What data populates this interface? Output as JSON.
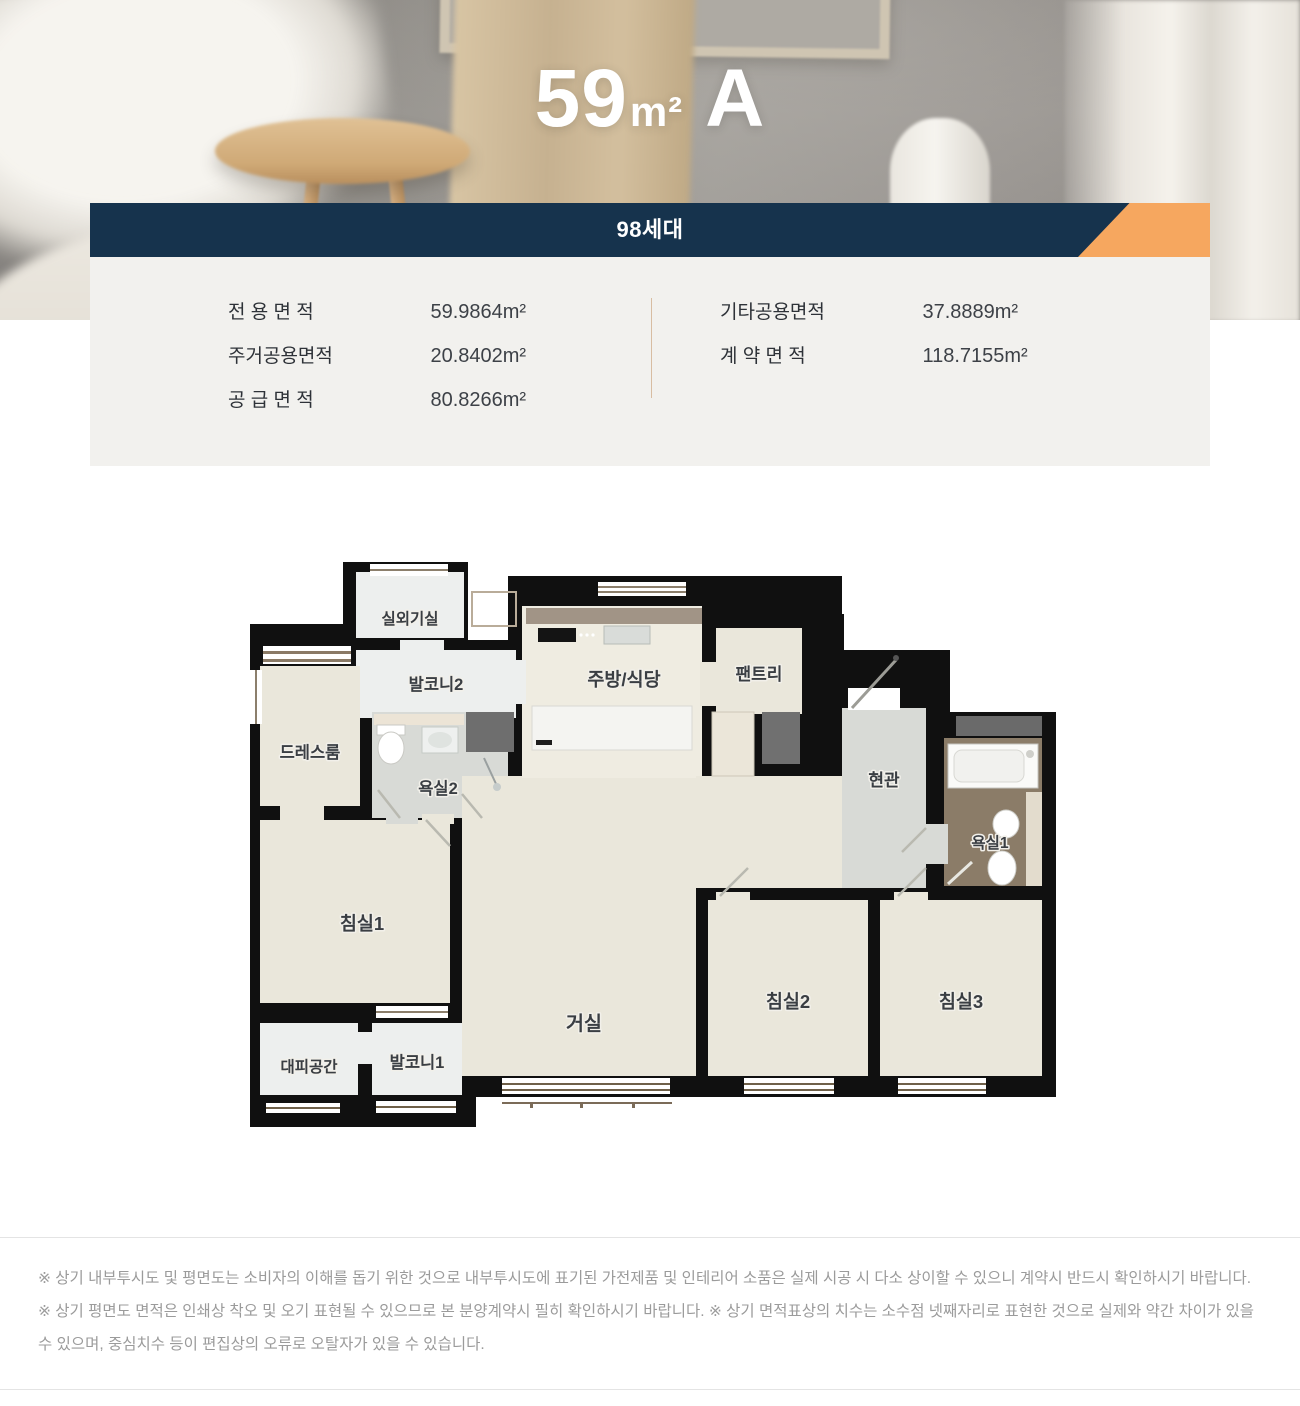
{
  "header": {
    "area_number": "59",
    "area_unit": "m²",
    "type_letter": "A"
  },
  "banner": {
    "units_label": "98세대",
    "navy_color": "#16334d",
    "accent_color": "#f6a75f"
  },
  "area_info": {
    "left": [
      {
        "label": "전 용 면 적",
        "value": "59.9864m²"
      },
      {
        "label": "주거공용면적",
        "value": "20.8402m²"
      },
      {
        "label": "공 급 면 적",
        "value": "80.8266m²"
      }
    ],
    "right": [
      {
        "label": "기타공용면적",
        "value": "37.8889m²"
      },
      {
        "label": "계 약 면 적",
        "value": "118.7155m²"
      }
    ]
  },
  "floor_plan": {
    "rooms": [
      {
        "id": "outdoor-unit-room",
        "label": "실외기실"
      },
      {
        "id": "balcony2",
        "label": "발코니2"
      },
      {
        "id": "kitchen-dining",
        "label": "주방/식당"
      },
      {
        "id": "pantry",
        "label": "팬트리"
      },
      {
        "id": "dress-room",
        "label": "드레스룸"
      },
      {
        "id": "bathroom2",
        "label": "욕실2"
      },
      {
        "id": "entrance",
        "label": "현관"
      },
      {
        "id": "bathroom1",
        "label": "욕실1"
      },
      {
        "id": "bedroom1",
        "label": "침실1"
      },
      {
        "id": "living-room",
        "label": "거실"
      },
      {
        "id": "bedroom2",
        "label": "침실2"
      },
      {
        "id": "bedroom3",
        "label": "침실3"
      },
      {
        "id": "shelter",
        "label": "대피공간"
      },
      {
        "id": "balcony1",
        "label": "발코니1"
      }
    ]
  },
  "footer": {
    "disclaimer": "※ 상기 내부투시도 및 평면도는 소비자의 이해를 돕기 위한 것으로 내부투시도에 표기된 가전제품 및 인테리어 소품은 실제 시공 시 다소 상이할 수 있으니 계약시 반드시 확인하시기 바랍니다. ※ 상기 평면도 면적은 인쇄상 착오 및 오기 표현될 수 있으므로 본 분양계약시 필히 확인하시기 바랍니다. ※ 상기 면적표상의 치수는 소수점 넷째자리로 표현한 것으로 실제와 약간 차이가 있을 수 있으며, 중심치수 등이 편집상의 오류로 오탈자가 있을 수 있습니다."
  }
}
